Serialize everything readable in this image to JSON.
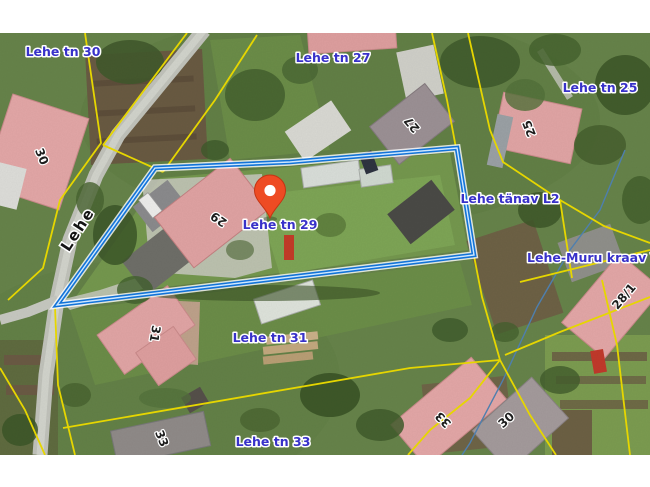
{
  "map": {
    "pin": {
      "label": "Lehe tn 29"
    },
    "street_name": "Lehe",
    "address_labels": [
      {
        "text": "Lehe tn 30"
      },
      {
        "text": "Lehe tn 27"
      },
      {
        "text": "Lehe tn 25"
      },
      {
        "text": "Lehe tänav L2"
      },
      {
        "text": "Lehe-Muru kraav V2"
      },
      {
        "text": "Lehe tn 31"
      },
      {
        "text": "Lehe tn 33"
      }
    ],
    "building_numbers": [
      {
        "text": "30"
      },
      {
        "text": "27"
      },
      {
        "text": "25"
      },
      {
        "text": "29"
      },
      {
        "text": "31"
      },
      {
        "text": "33"
      },
      {
        "text": "28/1"
      },
      {
        "text": "33"
      },
      {
        "text": "30"
      }
    ],
    "colors": {
      "selected_parcel": "#1273d8",
      "parcel_core": "#cfe8ff",
      "cadastral_line": "#e6d600",
      "address_label": "#3831c9",
      "pin": "#ee4b23",
      "stream": "#4e7fae"
    }
  }
}
